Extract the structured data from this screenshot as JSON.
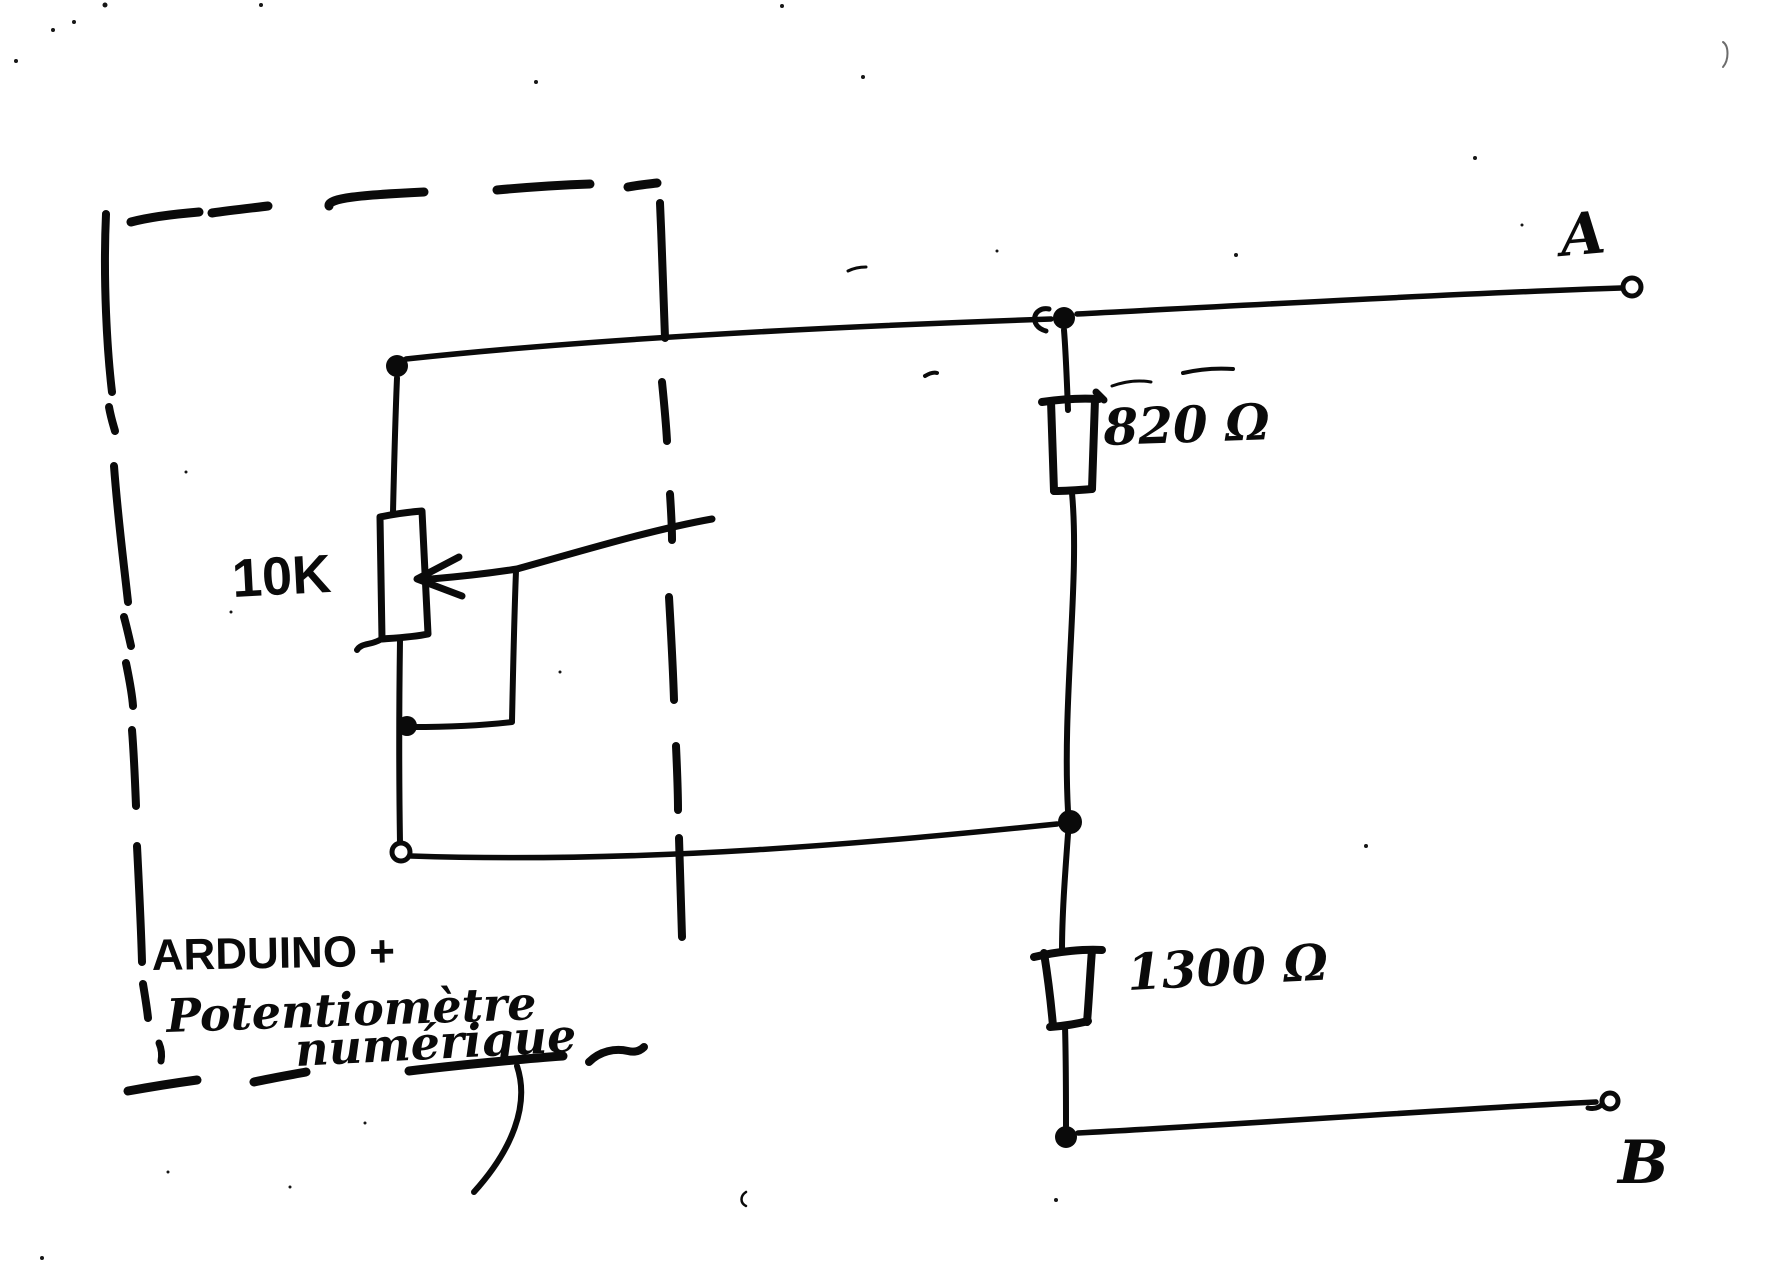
{
  "diagram": {
    "type": "hand-drawn circuit schematic",
    "ink_color": "#0a0a0a",
    "paper_color": "#ffffff",
    "labels": {
      "terminal_a": "A",
      "terminal_b": "B",
      "resistor_top_value": "820 Ω",
      "resistor_bottom_value": "1300 Ω",
      "potentiometer_value": "10K",
      "enclosure_line1": "ARDUINO +",
      "enclosure_line2": "Potentiomètre",
      "enclosure_line3": "numérique"
    },
    "components": [
      {
        "type": "enclosure",
        "style": "dashed box",
        "label": "ARDUINO + Potentiomètre numérique"
      },
      {
        "type": "potentiometer",
        "value": "10K",
        "note": "wiper arrow tied to lower leg"
      },
      {
        "type": "resistor",
        "value": "820 Ω",
        "position": "between terminal A node and middle junction"
      },
      {
        "type": "resistor",
        "value": "1300 Ω",
        "position": "between middle junction and terminal B node"
      },
      {
        "type": "terminal",
        "name": "A",
        "style": "open circle, top right"
      },
      {
        "type": "terminal",
        "name": "B",
        "style": "open circle, bottom right"
      }
    ]
  }
}
